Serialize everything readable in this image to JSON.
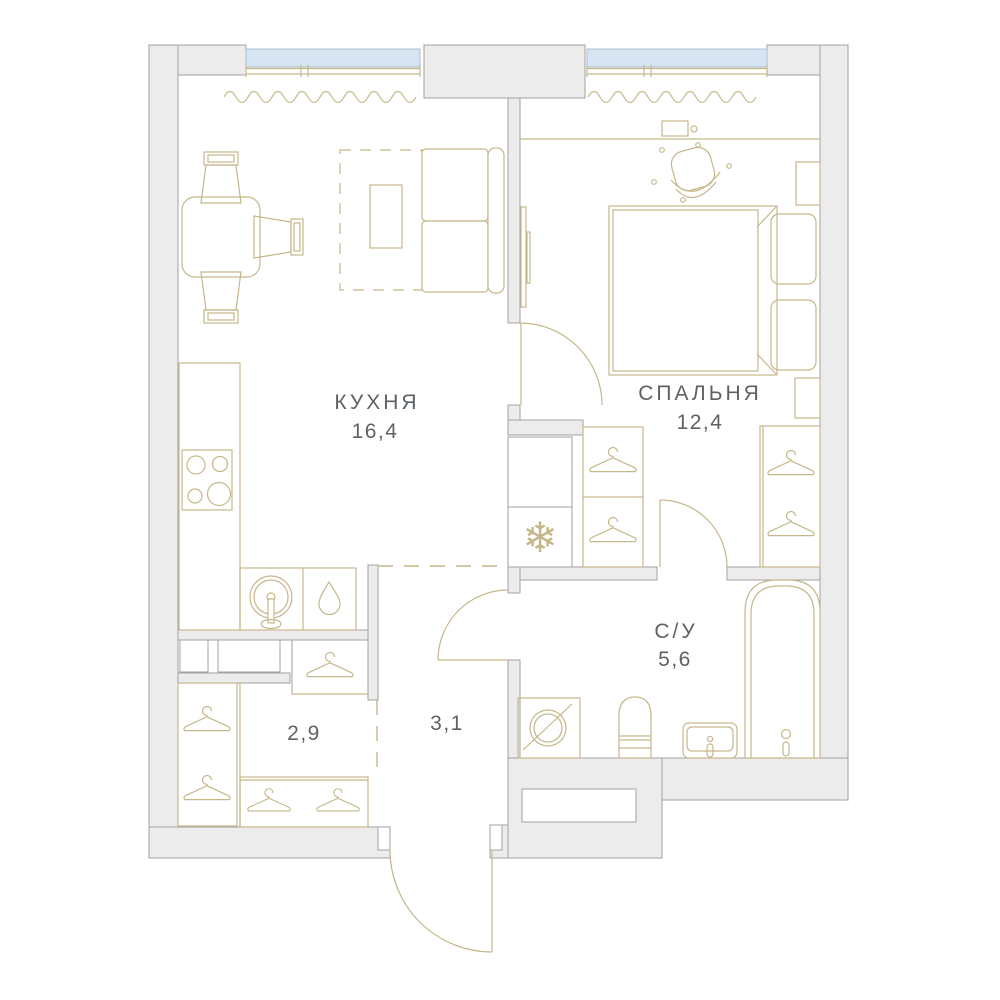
{
  "plan": {
    "rooms": [
      {
        "name": "КУХНЯ",
        "area": "16,4"
      },
      {
        "name": "СПАЛЬНЯ",
        "area": "12,4"
      },
      {
        "name": "С/У",
        "area": "5,6"
      },
      {
        "name": "",
        "area": "2,9"
      },
      {
        "name": "",
        "area": "3,1"
      }
    ],
    "icons": {
      "fridge": "❄"
    },
    "colors": {
      "wall_fill": "#ececec",
      "wall_stroke": "#a2a2a2",
      "furniture": "#c6b78a",
      "window_fill": "#d7e5f3",
      "window_stroke": "#aabfd1",
      "label": "#5d6267"
    }
  }
}
